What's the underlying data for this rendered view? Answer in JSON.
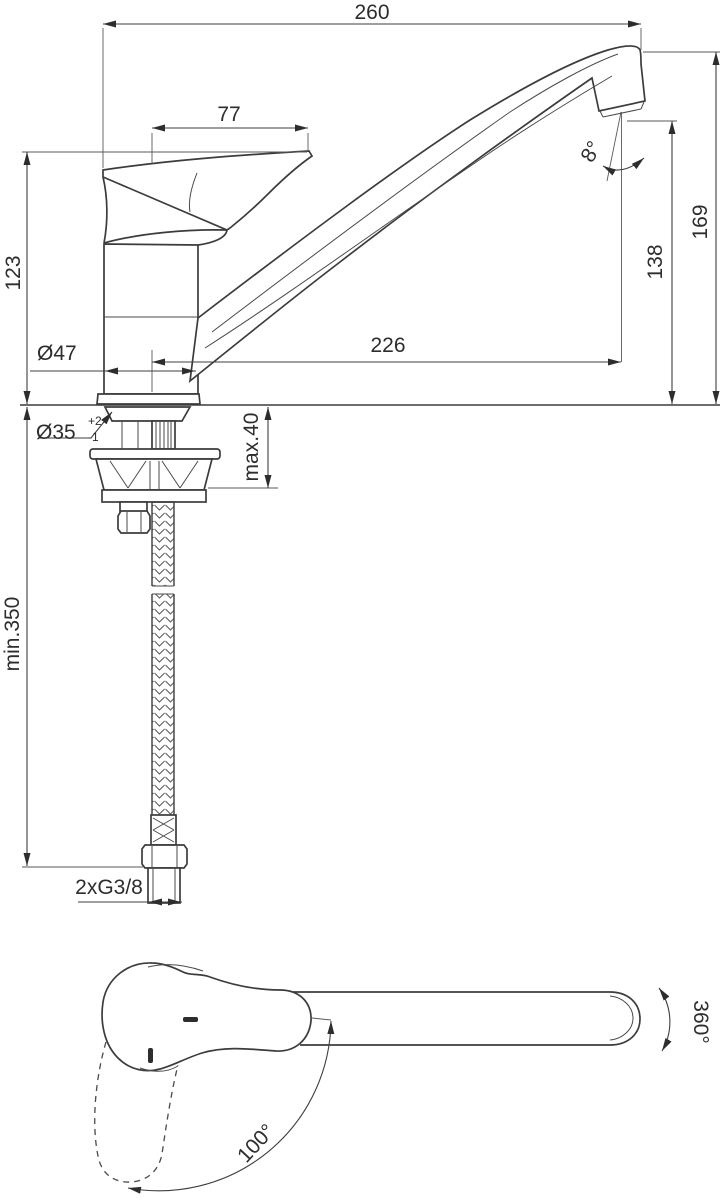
{
  "side_view": {
    "overall_width": "260",
    "lever_length": "77",
    "handle_height": "123",
    "spout_reach": "226",
    "spout_top_height": "169",
    "outlet_height": "138",
    "outlet_angle": "8°",
    "body_diameter": "Ø47",
    "hole_diameter": "Ø35",
    "hole_tolerance_plus": "+2",
    "hole_tolerance_minus": "-1",
    "deck_thickness": "max.40",
    "hose_length": "min.350",
    "hose_connection": "2xG3/8"
  },
  "top_view": {
    "spout_rotation": "360°",
    "lever_swing": "100°"
  }
}
